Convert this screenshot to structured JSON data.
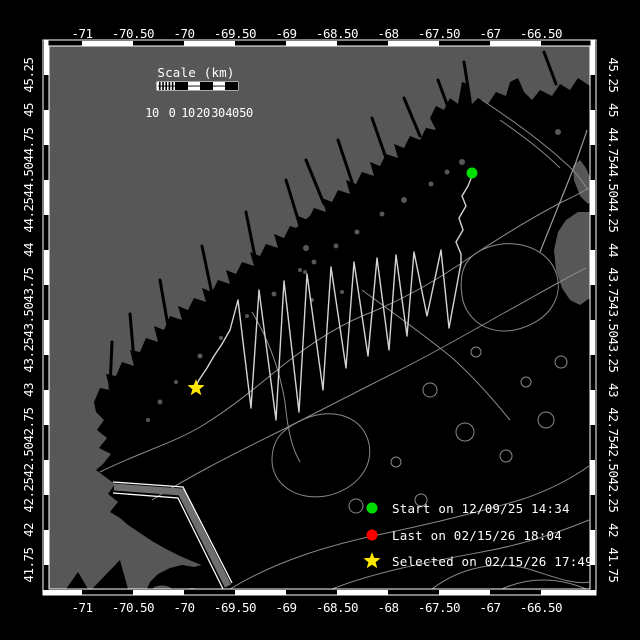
{
  "axes": {
    "top": [
      "-71",
      "-70.50",
      "-70",
      "-69.50",
      "-69",
      "-68.50",
      "-68",
      "-67.50",
      "-67",
      "-66.50"
    ],
    "bottom": [
      "-71",
      "-70.50",
      "-70",
      "-69.50",
      "-69",
      "-68.50",
      "-68",
      "-67.50",
      "-67",
      "-66.50"
    ],
    "left": [
      "45.25",
      "45",
      "44.75",
      "44.50",
      "44.25",
      "44",
      "43.75",
      "43.50",
      "43.25",
      "43",
      "42.75",
      "42.50",
      "42.25",
      "42",
      "41.75"
    ],
    "right": [
      "45.25",
      "45",
      "44.75",
      "44.50",
      "44.25",
      "44",
      "43.75",
      "43.50",
      "43.25",
      "43",
      "42.75",
      "42.50",
      "42.25",
      "42",
      "41.75"
    ]
  },
  "scalebar": {
    "title": "Scale (km)",
    "labels": [
      "10",
      "0",
      "10",
      "20",
      "30",
      "40",
      "50"
    ]
  },
  "legend": {
    "items": [
      {
        "marker": "circle",
        "color": "#00dd00",
        "label": "Start on 12/09/25 14:34"
      },
      {
        "marker": "circle",
        "color": "#ff0000",
        "label": "Last on 02/15/26 18:04"
      },
      {
        "marker": "star",
        "color": "#ffe800",
        "label": "Selected on 02/15/26 17:49"
      }
    ]
  },
  "map": {
    "markers": [
      {
        "name": "start",
        "marker": "circle",
        "color": "#00dd00"
      },
      {
        "name": "selected",
        "marker": "star",
        "color": "#ffe800"
      }
    ]
  },
  "colors": {
    "background": "#000000",
    "land": "#575757",
    "ocean": "#000000",
    "contour": "#8a8a8a",
    "track": "#d4d4d4",
    "frame": "#ffffff",
    "lane": "#ffffff",
    "start": "#00dd00",
    "last": "#ff0000",
    "selected": "#ffe800"
  }
}
